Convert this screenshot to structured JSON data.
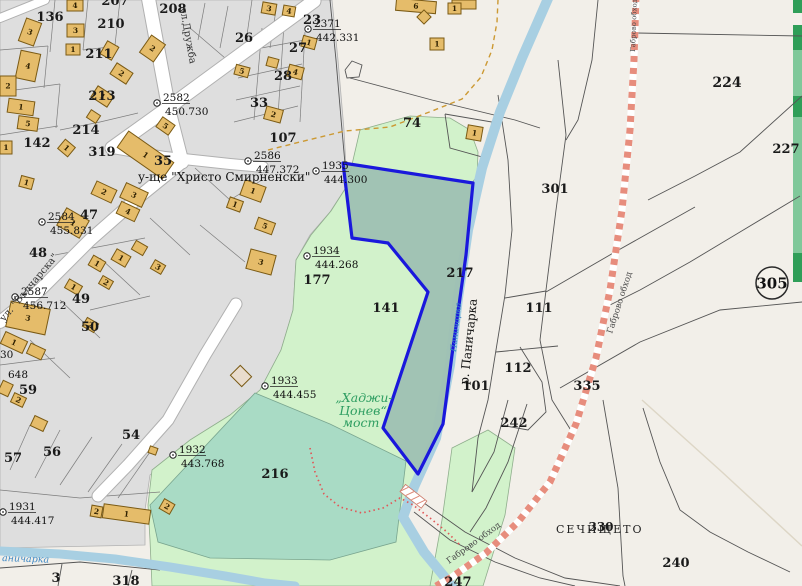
{
  "map": {
    "colors": {
      "urban": "#dedede",
      "rural": "#f2efe9",
      "building": "#e5bc6a",
      "building_outline": "#7a5a14",
      "green": "#d2f2cb",
      "field": "#a9dbc5",
      "selected_parcel_fill": "#9ec0b2",
      "selection_stroke": "#1a18dc",
      "river": "#a8cfe2",
      "road_dash": "#e78d7d",
      "path_orange": "#cc9933",
      "path_red": "#e05858",
      "green_strip_dark": "#2f9e58",
      "green_strip_med": "#80c89a"
    },
    "parcel_labels": [
      {
        "text": "136",
        "x": 50,
        "y": 21
      },
      {
        "text": "207",
        "x": 115,
        "y": 5
      },
      {
        "text": "208",
        "x": 173,
        "y": 13
      },
      {
        "text": "210",
        "x": 111,
        "y": 28
      },
      {
        "text": "211",
        "x": 99,
        "y": 58
      },
      {
        "text": "213",
        "x": 102,
        "y": 100
      },
      {
        "text": "214",
        "x": 86,
        "y": 134
      },
      {
        "text": "142",
        "x": 37,
        "y": 147
      },
      {
        "text": "319",
        "x": 102,
        "y": 156
      },
      {
        "text": "35",
        "x": 163,
        "y": 165
      },
      {
        "text": "23",
        "x": 312,
        "y": 24
      },
      {
        "text": "26",
        "x": 244,
        "y": 42
      },
      {
        "text": "27",
        "x": 298,
        "y": 52
      },
      {
        "text": "28",
        "x": 283,
        "y": 80
      },
      {
        "text": "33",
        "x": 259,
        "y": 107
      },
      {
        "text": "74",
        "x": 412,
        "y": 127
      },
      {
        "text": "107",
        "x": 283,
        "y": 142
      },
      {
        "text": "47",
        "x": 89,
        "y": 219
      },
      {
        "text": "48",
        "x": 38,
        "y": 257
      },
      {
        "text": "49",
        "x": 81,
        "y": 303
      },
      {
        "text": "50",
        "x": 90,
        "y": 331
      },
      {
        "text": "59",
        "x": 28,
        "y": 394
      },
      {
        "text": "56",
        "x": 52,
        "y": 456
      },
      {
        "text": "57",
        "x": 13,
        "y": 462
      },
      {
        "text": "54",
        "x": 131,
        "y": 439
      },
      {
        "text": "3",
        "x": 56,
        "y": 582
      },
      {
        "text": "318",
        "x": 126,
        "y": 585
      },
      {
        "text": "177",
        "x": 317,
        "y": 284
      },
      {
        "text": "141",
        "x": 386,
        "y": 312
      },
      {
        "text": "216",
        "x": 275,
        "y": 478
      },
      {
        "text": "217",
        "x": 460,
        "y": 277
      },
      {
        "text": "101",
        "x": 476,
        "y": 390
      },
      {
        "text": "111",
        "x": 539,
        "y": 312
      },
      {
        "text": "112",
        "x": 518,
        "y": 372
      },
      {
        "text": "242",
        "x": 514,
        "y": 427
      },
      {
        "text": "224",
        "x": 727,
        "y": 87,
        "size": 14
      },
      {
        "text": "227",
        "x": 786,
        "y": 153
      },
      {
        "text": "301",
        "x": 555,
        "y": 193
      },
      {
        "text": "335",
        "x": 587,
        "y": 390
      },
      {
        "text": "240",
        "x": 676,
        "y": 567
      },
      {
        "text": "247",
        "x": 458,
        "y": 586
      },
      {
        "text": "330",
        "x": 601,
        "y": 531,
        "size": 12
      }
    ],
    "partial_labels": [
      {
        "text": "30",
        "x": 0,
        "y": 358
      },
      {
        "text": "648",
        "x": 8,
        "y": 378
      }
    ],
    "survey_points": [
      {
        "id": "2371",
        "elevation": "442.331",
        "x": 308,
        "y": 29
      },
      {
        "id": "2582",
        "elevation": "450.730",
        "x": 157,
        "y": 103
      },
      {
        "id": "2584",
        "elevation": "455.831",
        "x": 42,
        "y": 222
      },
      {
        "id": "2586",
        "elevation": "447.372",
        "x": 248,
        "y": 161
      },
      {
        "id": "2587",
        "elevation": "456.712",
        "x": 15,
        "y": 297
      },
      {
        "id": "1931",
        "elevation": "444.417",
        "x": 3,
        "y": 512
      },
      {
        "id": "1932",
        "elevation": "443.768",
        "x": 173,
        "y": 455
      },
      {
        "id": "1933",
        "elevation": "444.455",
        "x": 265,
        "y": 386
      },
      {
        "id": "1934",
        "elevation": "444.268",
        "x": 307,
        "y": 256
      },
      {
        "id": "1935",
        "elevation": "444.300",
        "x": 316,
        "y": 171
      }
    ],
    "named_labels": [
      {
        "name": "street-name-druzhba",
        "text": "ул.Дружба",
        "x": 180,
        "y": 8,
        "rot": 80,
        "size": 10,
        "color": "#333333"
      },
      {
        "name": "street-name-valcharska",
        "text": "ул. \"Вълчарска\"",
        "x": 4,
        "y": 322,
        "rot": -50,
        "size": 10,
        "color": "#333333"
      },
      {
        "name": "school-label",
        "text": "у-ще \"Христо Смирненски\"",
        "x": 138,
        "y": 181,
        "rot": 0,
        "size": 12,
        "color": "#111111"
      },
      {
        "name": "river-name-main",
        "text": "р. Паничарка",
        "x": 468,
        "y": 385,
        "rot": -84,
        "size": 12,
        "color": "#111111"
      },
      {
        "name": "river-name-small",
        "text": "Паничарка",
        "x": 456,
        "y": 352,
        "rot": -84,
        "size": 8.5,
        "color": "#3c87c4",
        "italic": true
      },
      {
        "name": "river-name-bottom",
        "text": "аничарка",
        "x": 2,
        "y": 561,
        "rot": 2,
        "size": 9.5,
        "color": "#3c87c4",
        "italic": true
      },
      {
        "name": "road-name-gabrovo-obhod-top",
        "text": "Габрово обход",
        "x": 635,
        "y": 52,
        "rot": -88,
        "size": 7,
        "color": "#4a4a4a"
      },
      {
        "name": "road-name-gabrovo-obhod-mid",
        "text": "Габрово обход",
        "x": 612,
        "y": 334,
        "rot": -72,
        "size": 8.5,
        "color": "#4a4a4a"
      },
      {
        "name": "road-name-gabrovo-obhod-bottom",
        "text": "Габрово обход",
        "x": 449,
        "y": 564,
        "rot": -36,
        "size": 8.5,
        "color": "#4a4a4a"
      },
      {
        "name": "bridge-label-line1",
        "text": "„Хаджи-",
        "x": 364,
        "y": 402,
        "rot": 0,
        "size": 12.5,
        "color": "#2f9e62",
        "italic": true,
        "anchor": "middle"
      },
      {
        "name": "bridge-label-line2",
        "text": "Цонев“",
        "x": 363,
        "y": 415,
        "rot": 0,
        "size": 12.5,
        "color": "#2f9e62",
        "italic": true,
        "anchor": "middle"
      },
      {
        "name": "bridge-label-line3",
        "text": "мост",
        "x": 361,
        "y": 427,
        "rot": 0,
        "size": 12.5,
        "color": "#2f9e62",
        "italic": true,
        "anchor": "middle"
      },
      {
        "name": "locality-label-sechishteto",
        "text": "СЕЧИЩЕТО",
        "x": 556,
        "y": 533,
        "rot": 0,
        "size": 11,
        "color": "#222222",
        "spacing": 2
      }
    ],
    "road_shield": {
      "text": "305",
      "x": 772,
      "y": 283
    },
    "green_strips": [
      {
        "y": 0,
        "h": 13,
        "shade": "dark"
      },
      {
        "y": 25,
        "h": 25,
        "shade": "dark"
      },
      {
        "y": 50,
        "h": 46,
        "shade": "med"
      },
      {
        "y": 96,
        "h": 21,
        "shade": "dark"
      },
      {
        "y": 117,
        "h": 136,
        "shade": "med"
      },
      {
        "y": 253,
        "h": 29,
        "shade": "dark"
      }
    ],
    "buildings": [
      {
        "x": 22,
        "y": 20,
        "w": 16,
        "h": 24,
        "r": 20,
        "num": "3"
      },
      {
        "x": 18,
        "y": 52,
        "w": 20,
        "h": 28,
        "r": 12,
        "num": "4"
      },
      {
        "x": 0,
        "y": 76,
        "w": 16,
        "h": 20,
        "r": 0,
        "num": "2"
      },
      {
        "x": 8,
        "y": 100,
        "w": 26,
        "h": 14,
        "r": 8,
        "num": "1"
      },
      {
        "x": 18,
        "y": 117,
        "w": 20,
        "h": 13,
        "r": 8,
        "num": "5"
      },
      {
        "x": 0,
        "y": 141,
        "w": 12,
        "h": 13,
        "r": 0,
        "num": "1"
      },
      {
        "x": 60,
        "y": 142,
        "w": 13,
        "h": 12,
        "r": 40,
        "num": "1"
      },
      {
        "x": 67,
        "y": 0,
        "w": 16,
        "h": 11,
        "r": 0,
        "num": "4"
      },
      {
        "x": 67,
        "y": 24,
        "w": 17,
        "h": 13,
        "r": 0,
        "num": "3"
      },
      {
        "x": 66,
        "y": 44,
        "w": 14,
        "h": 11,
        "r": 0,
        "num": "1"
      },
      {
        "x": 103,
        "y": 43,
        "w": 13,
        "h": 15,
        "r": 30,
        "num": ""
      },
      {
        "x": 144,
        "y": 38,
        "w": 17,
        "h": 21,
        "r": 35,
        "num": "2"
      },
      {
        "x": 112,
        "y": 67,
        "w": 19,
        "h": 13,
        "r": 33,
        "num": "2"
      },
      {
        "x": 93,
        "y": 90,
        "w": 19,
        "h": 13,
        "r": 33,
        "num": "1"
      },
      {
        "x": 88,
        "y": 112,
        "w": 11,
        "h": 9,
        "r": 33,
        "num": ""
      },
      {
        "x": 158,
        "y": 120,
        "w": 15,
        "h": 12,
        "r": 35,
        "num": "5"
      },
      {
        "x": 118,
        "y": 145,
        "w": 55,
        "h": 20,
        "r": 35,
        "num": "1"
      },
      {
        "x": 20,
        "y": 177,
        "w": 13,
        "h": 11,
        "r": 15,
        "num": "1"
      },
      {
        "x": 93,
        "y": 185,
        "w": 22,
        "h": 14,
        "r": 25,
        "num": "2"
      },
      {
        "x": 122,
        "y": 187,
        "w": 24,
        "h": 16,
        "r": 25,
        "num": "3"
      },
      {
        "x": 118,
        "y": 205,
        "w": 20,
        "h": 13,
        "r": 25,
        "num": "4"
      },
      {
        "x": 60,
        "y": 213,
        "w": 26,
        "h": 20,
        "r": 30,
        "num": "1"
      },
      {
        "x": 90,
        "y": 258,
        "w": 14,
        "h": 11,
        "r": 30,
        "num": "1"
      },
      {
        "x": 113,
        "y": 252,
        "w": 16,
        "h": 12,
        "r": 30,
        "num": "1"
      },
      {
        "x": 133,
        "y": 243,
        "w": 13,
        "h": 10,
        "r": 30,
        "num": ""
      },
      {
        "x": 152,
        "y": 262,
        "w": 12,
        "h": 10,
        "r": 30,
        "num": "3"
      },
      {
        "x": 100,
        "y": 278,
        "w": 12,
        "h": 9,
        "r": 30,
        "num": "2"
      },
      {
        "x": 66,
        "y": 282,
        "w": 15,
        "h": 10,
        "r": 30,
        "num": "1"
      },
      {
        "x": 84,
        "y": 320,
        "w": 13,
        "h": 10,
        "r": 30,
        "num": "2"
      },
      {
        "x": 30,
        "y": 320,
        "w": 13,
        "h": 11,
        "r": 25,
        "num": "1"
      },
      {
        "x": 2,
        "y": 336,
        "w": 24,
        "h": 13,
        "r": 25,
        "num": "1"
      },
      {
        "x": 28,
        "y": 346,
        "w": 16,
        "h": 11,
        "r": 25,
        "num": ""
      },
      {
        "x": 0,
        "y": 382,
        "w": 11,
        "h": 13,
        "r": 25,
        "num": ""
      },
      {
        "x": 12,
        "y": 395,
        "w": 13,
        "h": 10,
        "r": 25,
        "num": "2"
      },
      {
        "x": 32,
        "y": 418,
        "w": 14,
        "h": 11,
        "r": 25,
        "num": ""
      },
      {
        "x": 91,
        "y": 506,
        "w": 11,
        "h": 11,
        "r": 10,
        "num": "2"
      },
      {
        "x": 103,
        "y": 507,
        "w": 47,
        "h": 14,
        "r": 8,
        "num": "1"
      },
      {
        "x": 161,
        "y": 501,
        "w": 12,
        "h": 11,
        "r": 30,
        "num": "2"
      },
      {
        "x": 149,
        "y": 447,
        "w": 8,
        "h": 7,
        "r": 20,
        "num": ""
      },
      {
        "x": 8,
        "y": 305,
        "w": 40,
        "h": 26,
        "r": 12,
        "num": "3"
      },
      {
        "x": 242,
        "y": 183,
        "w": 22,
        "h": 16,
        "r": 20,
        "num": "1"
      },
      {
        "x": 228,
        "y": 199,
        "w": 14,
        "h": 11,
        "r": 20,
        "num": "1"
      },
      {
        "x": 256,
        "y": 220,
        "w": 18,
        "h": 12,
        "r": 20,
        "num": "5"
      },
      {
        "x": 248,
        "y": 252,
        "w": 26,
        "h": 20,
        "r": 15,
        "num": "3"
      },
      {
        "x": 396,
        "y": 0,
        "w": 40,
        "h": 12,
        "r": 5,
        "num": "6"
      },
      {
        "x": 452,
        "y": 0,
        "w": 24,
        "h": 9,
        "r": 0,
        "num": ""
      },
      {
        "x": 419,
        "y": 12,
        "w": 10,
        "h": 10,
        "r": 45,
        "num": ""
      },
      {
        "x": 467,
        "y": 126,
        "w": 15,
        "h": 14,
        "r": 10,
        "num": "1"
      },
      {
        "x": 262,
        "y": 3,
        "w": 14,
        "h": 11,
        "r": 10,
        "num": "3"
      },
      {
        "x": 283,
        "y": 6,
        "w": 12,
        "h": 10,
        "r": 10,
        "num": "4"
      },
      {
        "x": 233,
        "y": 369,
        "w": 16,
        "h": 14,
        "r": 45,
        "num": "",
        "fill": "#e9dccd"
      },
      {
        "x": 265,
        "y": 108,
        "w": 17,
        "h": 13,
        "r": 15,
        "num": "2"
      },
      {
        "x": 430,
        "y": 38,
        "w": 14,
        "h": 12,
        "r": 0,
        "num": "1"
      },
      {
        "x": 448,
        "y": 3,
        "w": 13,
        "h": 11,
        "r": 0,
        "num": "1"
      },
      {
        "x": 302,
        "y": 37,
        "w": 14,
        "h": 11,
        "r": 15,
        "num": "1"
      },
      {
        "x": 235,
        "y": 66,
        "w": 14,
        "h": 10,
        "r": 15,
        "num": "5"
      },
      {
        "x": 288,
        "y": 66,
        "w": 15,
        "h": 12,
        "r": 15,
        "num": "4"
      },
      {
        "x": 267,
        "y": 58,
        "w": 11,
        "h": 9,
        "r": 15,
        "num": ""
      }
    ]
  }
}
